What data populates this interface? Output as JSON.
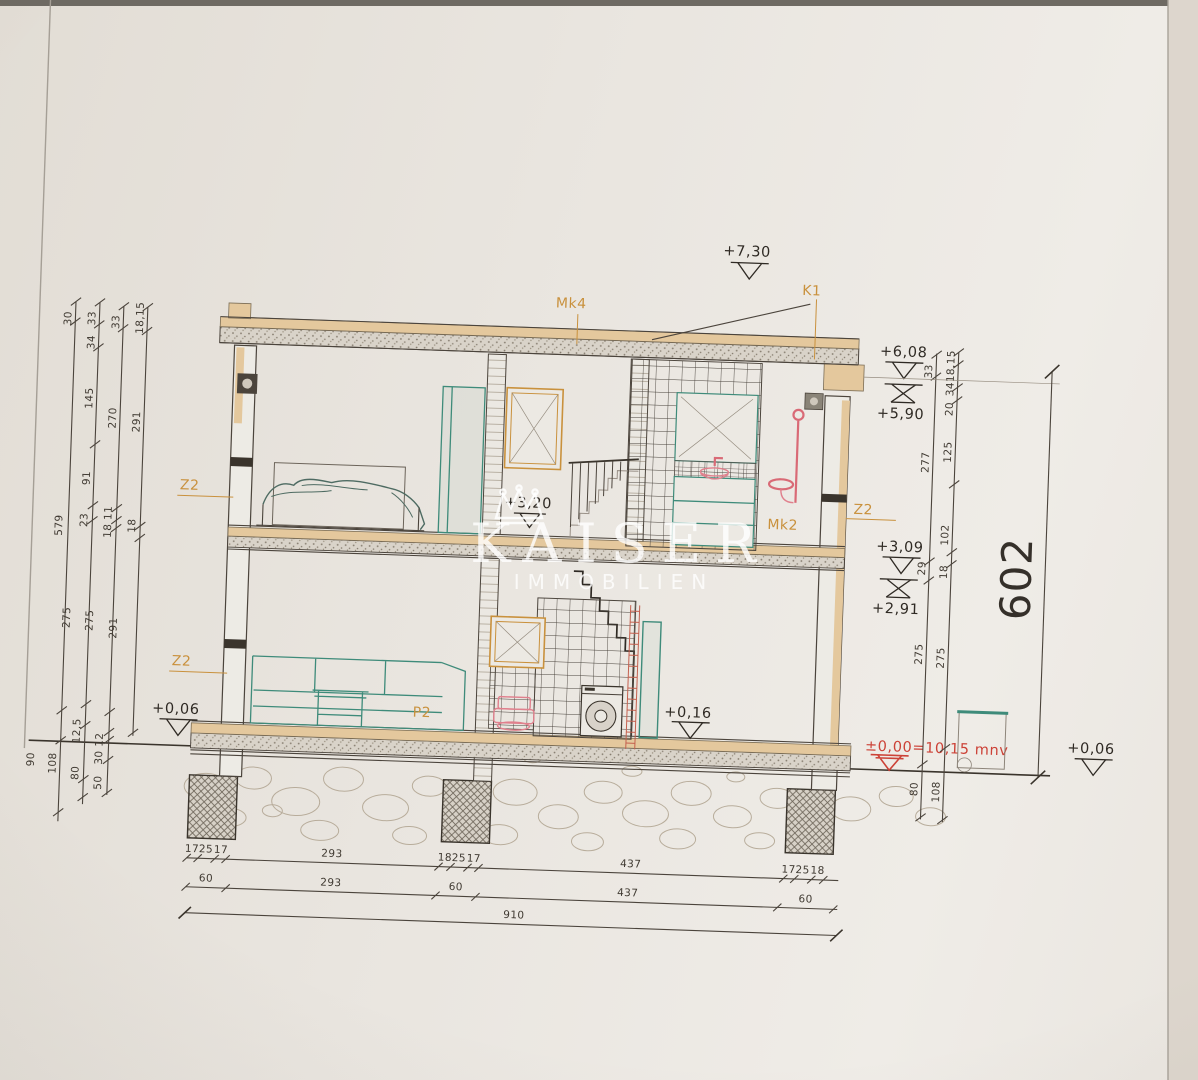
{
  "watermark": {
    "title": "KAISER",
    "subtitle": "IMMOBILIEN"
  },
  "markers": {
    "roof": "+7,30",
    "roof_edge_top": "+6,08",
    "roof_edge_bottom": "+5,90",
    "upper_floor": "+3,20",
    "upper_slab_top": "+3,09",
    "upper_slab_bottom": "+2,91",
    "terrain_left": "+0,06",
    "ground_floor": "+0,16",
    "datum": "±0,00=10,15 mnv",
    "terrain_right": "+0,06"
  },
  "tags": {
    "mk4": "Mk4",
    "k1": "K1",
    "z2_upper_left": "Z2",
    "z2_lower_left": "Z2",
    "z2_right": "Z2",
    "mk2": "Mk2",
    "p2": "P2"
  },
  "dims": {
    "overall": "602",
    "left": [
      "30",
      "33",
      "33",
      "18,15",
      "34",
      "145",
      "270",
      "291",
      "91",
      "579",
      "23",
      "18 11",
      "18",
      "275",
      "275",
      "291",
      "90",
      "108",
      "12,5",
      "80",
      "30 12",
      "50"
    ],
    "right": [
      "33",
      "18,15",
      "34",
      "20",
      "277",
      "125",
      "102",
      "29",
      "18",
      "275",
      "275",
      "80",
      "108"
    ],
    "bottom1": [
      "17",
      "25",
      "17",
      "293",
      "18",
      "25",
      "17",
      "437",
      "17",
      "25",
      "18"
    ],
    "bottom2": [
      "60",
      "293",
      "60",
      "437",
      "60"
    ],
    "bottom3": [
      "910"
    ]
  }
}
